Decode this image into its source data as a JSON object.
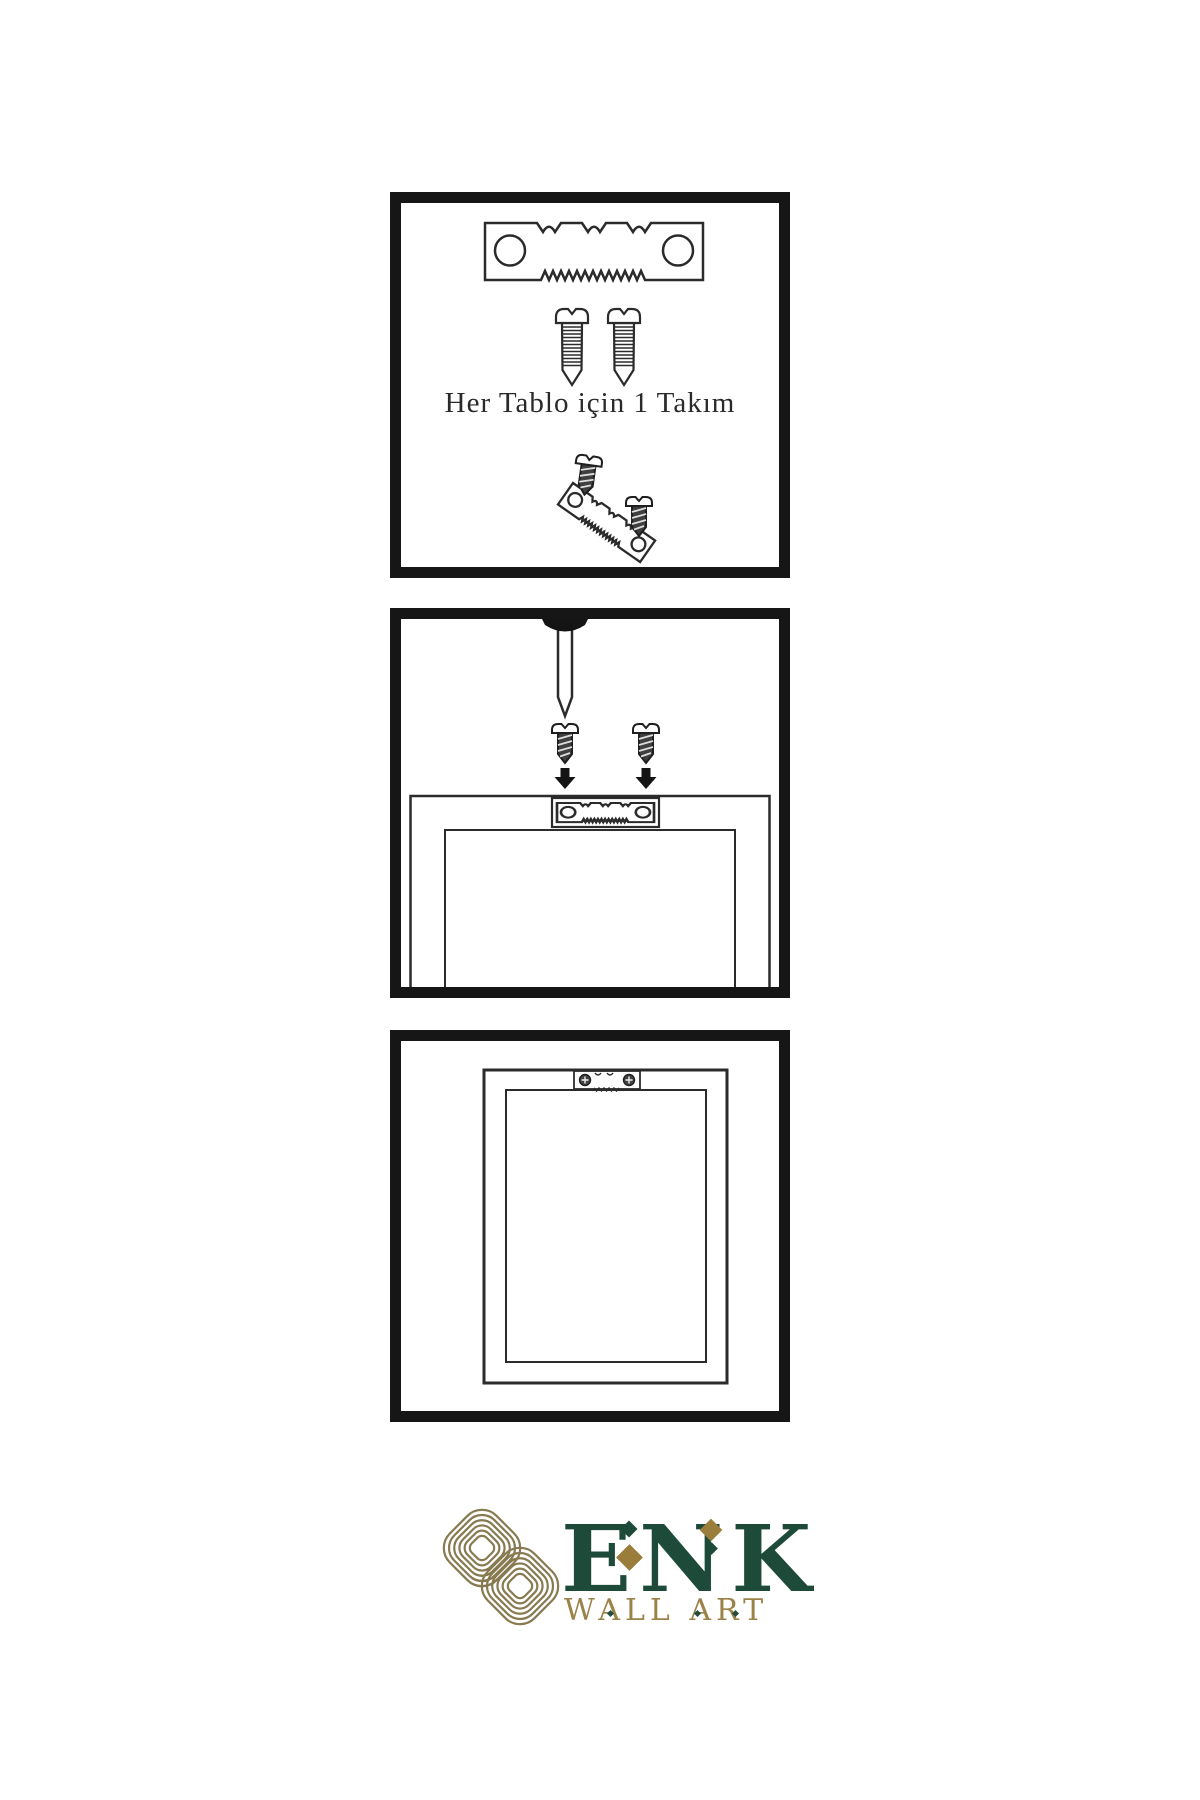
{
  "page": {
    "background": "#ffffff",
    "type": "wall-art-hanging-instructions"
  },
  "colors": {
    "panel_border": "#161616",
    "line_art": "#2b2b2b",
    "brand_green": "#1e4a3a",
    "knot_gold": "#877950",
    "tagline_gold": "#9b8249"
  },
  "steps": {
    "step1": {
      "caption": "Her Tablo için 1 Takım",
      "illustrations": [
        "sawtooth-hanger",
        "screw",
        "screw",
        "angled-hanger-with-screws"
      ]
    },
    "step2": {
      "illustrations": [
        "wall-nail",
        "screw-with-down-arrow",
        "screw-with-down-arrow",
        "frame-back-with-sawtooth-hanger"
      ]
    },
    "step3": {
      "illustrations": [
        "hanging-frame-with-mounted-sawtooth-hanger"
      ]
    }
  },
  "brand": {
    "name": "ENK",
    "tagline": "WALL ART",
    "logo_icon": "interlaced-knot-icon"
  }
}
